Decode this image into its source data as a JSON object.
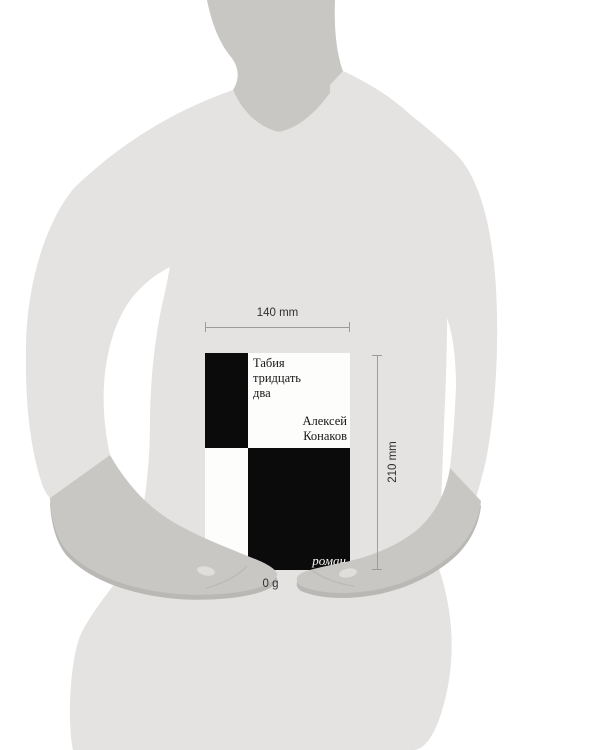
{
  "figure": {
    "colors": {
      "body": "#e4e3e1",
      "skin": "#c8c7c4",
      "skin_shadow": "#b9b8b5",
      "nail": "#dfdedb"
    }
  },
  "book": {
    "title_lines": [
      "Табия",
      "тридцать",
      "два"
    ],
    "author_lines": [
      "Алексей",
      "Конаков"
    ],
    "age_rating": "18+",
    "genre_label": "роман",
    "colors": {
      "cover_black": "#0b0b0b",
      "cover_white": "#fdfdfc",
      "text": "#161616"
    }
  },
  "measurements": {
    "width_label": "140 mm",
    "height_label": "210 mm",
    "weight_label": "0 g",
    "line_color": "#9c9c9c",
    "text_color": "#2f2f2f"
  }
}
